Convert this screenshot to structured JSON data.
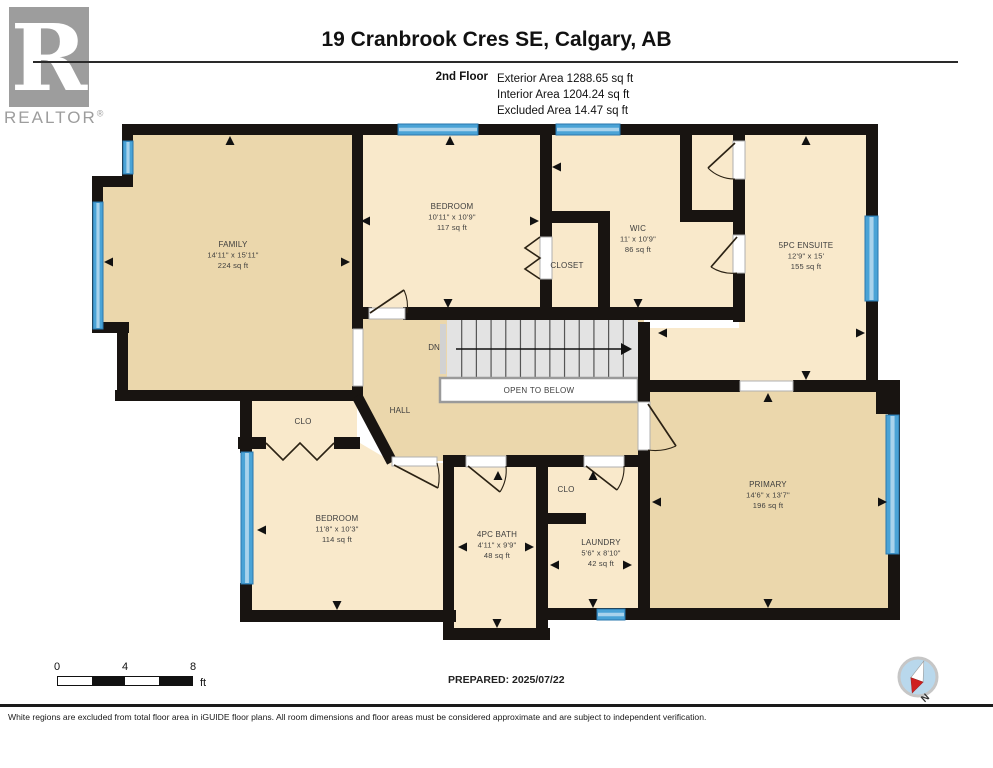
{
  "logo": {
    "letter": "R",
    "brand": "REALTOR",
    "registered": "®"
  },
  "header": {
    "title": "19 Cranbrook Cres SE, Calgary, AB",
    "floor_label": "2nd Floor",
    "stats": [
      "Exterior Area 1288.65 sq ft",
      "Interior Area 1204.24 sq ft",
      "Excluded Area 14.47 sq ft"
    ]
  },
  "scale_bar": {
    "tick_labels": [
      "0",
      "4",
      "8"
    ],
    "unit": "ft"
  },
  "prepared": "PREPARED: 2025/07/22",
  "compass": {
    "label": "N"
  },
  "disclaimer": "White regions are excluded from total floor area in iGUIDE floor plans. All room dimensions and floor areas must be considered approximate and are subject to independent verification.",
  "colors": {
    "tan": "#ebd7ac",
    "cream": "#f9e9cb",
    "wall": "#181411",
    "window_fill": "#4aa3d6",
    "window_edge": "#2a77ad",
    "window_stripe": "#a9d3ec",
    "stair_fill": "#e3e3e3",
    "stair_line": "#555555",
    "open_below_border": "#9a9a9a",
    "door": "#2b2214",
    "label": "#3d3d3d",
    "arrow": "#111111"
  },
  "plan": {
    "rooms": [
      {
        "id": "family",
        "fill": "tan",
        "points": [
          [
            128,
            130
          ],
          [
            357,
            130
          ],
          [
            357,
            395
          ],
          [
            120,
            395
          ],
          [
            120,
            328
          ],
          [
            98,
            328
          ],
          [
            98,
            182
          ],
          [
            128,
            182
          ]
        ]
      },
      {
        "id": "bedroom-2",
        "fill": "cream",
        "points": [
          [
            357,
            130
          ],
          [
            546,
            130
          ],
          [
            546,
            314
          ],
          [
            357,
            314
          ]
        ]
      },
      {
        "id": "closet",
        "fill": "cream",
        "points": [
          [
            546,
            217
          ],
          [
            604,
            217
          ],
          [
            604,
            314
          ],
          [
            546,
            314
          ]
        ]
      },
      {
        "id": "wic",
        "fill": "cream",
        "points": [
          [
            546,
            130
          ],
          [
            686,
            130
          ],
          [
            686,
            216
          ],
          [
            739,
            216
          ],
          [
            739,
            316
          ],
          [
            604,
            316
          ],
          [
            604,
            217
          ],
          [
            546,
            217
          ]
        ]
      },
      {
        "id": "water-closet",
        "fill": "cream",
        "points": [
          [
            686,
            130
          ],
          [
            739,
            130
          ],
          [
            739,
            216
          ],
          [
            686,
            216
          ]
        ]
      },
      {
        "id": "ensuite",
        "fill": "cream",
        "points": [
          [
            739,
            130
          ],
          [
            872,
            130
          ],
          [
            872,
            386
          ],
          [
            644,
            386
          ],
          [
            644,
            328
          ],
          [
            739,
            328
          ]
        ]
      },
      {
        "id": "hall",
        "fill": "tan",
        "points": [
          [
            357,
            310
          ],
          [
            644,
            310
          ],
          [
            644,
            461
          ],
          [
            390,
            461
          ],
          [
            355,
            398
          ],
          [
            357,
            390
          ]
        ]
      },
      {
        "id": "clo-hall",
        "fill": "cream",
        "points": [
          [
            246,
            396
          ],
          [
            357,
            396
          ],
          [
            357,
            443
          ],
          [
            246,
            443
          ]
        ]
      },
      {
        "id": "bedroom-3",
        "fill": "cream",
        "points": [
          [
            246,
            443
          ],
          [
            360,
            443
          ],
          [
            394,
            463
          ],
          [
            449,
            463
          ],
          [
            449,
            616
          ],
          [
            246,
            616
          ]
        ]
      },
      {
        "id": "bath",
        "fill": "cream",
        "points": [
          [
            449,
            461
          ],
          [
            542,
            461
          ],
          [
            542,
            634
          ],
          [
            449,
            634
          ]
        ]
      },
      {
        "id": "laundry",
        "fill": "cream",
        "points": [
          [
            542,
            461
          ],
          [
            644,
            461
          ],
          [
            644,
            614
          ],
          [
            542,
            614
          ]
        ]
      },
      {
        "id": "primary",
        "fill": "tan",
        "points": [
          [
            644,
            386
          ],
          [
            894,
            386
          ],
          [
            894,
            614
          ],
          [
            644,
            614
          ]
        ]
      }
    ],
    "walls": [
      [
        122,
        124,
        756,
        11
      ],
      [
        122,
        124,
        11,
        63
      ],
      [
        92,
        176,
        41,
        11
      ],
      [
        92,
        176,
        11,
        157
      ],
      [
        92,
        322,
        37,
        11
      ],
      [
        117,
        322,
        11,
        79
      ],
      [
        115,
        390,
        248,
        11
      ],
      [
        352,
        124,
        11,
        205
      ],
      [
        352,
        386,
        11,
        15
      ],
      [
        362,
        307,
        10,
        12
      ],
      [
        403,
        307,
        342,
        13
      ],
      [
        540,
        124,
        12,
        113
      ],
      [
        540,
        279,
        12,
        36
      ],
      [
        540,
        211,
        70,
        12
      ],
      [
        598,
        211,
        12,
        104
      ],
      [
        680,
        124,
        12,
        98
      ],
      [
        680,
        210,
        65,
        12
      ],
      [
        733,
        124,
        12,
        17
      ],
      [
        733,
        179,
        12,
        56
      ],
      [
        733,
        273,
        12,
        49
      ],
      [
        866,
        124,
        12,
        268
      ],
      [
        650,
        380,
        90,
        12
      ],
      [
        793,
        380,
        107,
        12
      ],
      [
        876,
        380,
        24,
        34
      ],
      [
        888,
        380,
        12,
        240
      ],
      [
        638,
        322,
        12,
        80
      ],
      [
        638,
        450,
        12,
        170
      ],
      [
        443,
        455,
        23,
        12
      ],
      [
        506,
        455,
        44,
        12
      ],
      [
        548,
        455,
        36,
        12
      ],
      [
        624,
        455,
        22,
        12
      ],
      [
        443,
        455,
        11,
        185
      ],
      [
        536,
        455,
        12,
        185
      ],
      [
        548,
        513,
        38,
        11
      ],
      [
        240,
        610,
        216,
        12
      ],
      [
        443,
        628,
        107,
        12
      ],
      [
        536,
        608,
        364,
        12
      ],
      [
        240,
        390,
        12,
        63
      ],
      [
        240,
        583,
        12,
        39
      ],
      [
        238,
        437,
        28,
        12
      ],
      [
        334,
        437,
        26,
        12
      ]
    ],
    "diag_walls": [
      [
        357,
        396,
        392,
        462
      ]
    ],
    "windows": [
      [
        123,
        141,
        10,
        33
      ],
      [
        93,
        202,
        10,
        127
      ],
      [
        398,
        124,
        80,
        11
      ],
      [
        556,
        124,
        64,
        11
      ],
      [
        865,
        216,
        13,
        85
      ],
      [
        886,
        415,
        13,
        139
      ],
      [
        241,
        452,
        12,
        132
      ],
      [
        597,
        609,
        28,
        11
      ]
    ],
    "openings": [
      {
        "x": 353,
        "y": 329,
        "w": 10,
        "h": 57
      },
      {
        "x": 369,
        "y": 308,
        "w": 36,
        "h": 11
      },
      {
        "x": 740,
        "y": 381,
        "w": 53,
        "h": 10
      },
      {
        "x": 733,
        "y": 141,
        "w": 12,
        "h": 38
      },
      {
        "x": 733,
        "y": 235,
        "w": 12,
        "h": 38
      },
      {
        "x": 540,
        "y": 237,
        "w": 12,
        "h": 42
      },
      {
        "x": 638,
        "y": 402,
        "w": 12,
        "h": 48
      },
      {
        "x": 466,
        "y": 456,
        "w": 40,
        "h": 11
      },
      {
        "x": 584,
        "y": 456,
        "w": 40,
        "h": 11
      },
      {
        "x": 392,
        "y": 457,
        "w": 45,
        "h": 9
      }
    ],
    "doors": [
      {
        "hx": 370,
        "hy": 313,
        "tx": 404,
        "ty": 290,
        "wx": 407,
        "wy": 313
      },
      {
        "hx": 735,
        "hy": 143,
        "tx": 708,
        "ty": 168,
        "wx": 735,
        "wy": 179
      },
      {
        "hx": 737,
        "hy": 237,
        "tx": 711,
        "ty": 267,
        "wx": 737,
        "wy": 273
      },
      {
        "hx": 648,
        "hy": 404,
        "tx": 676,
        "ty": 446,
        "wx": 648,
        "wy": 450
      },
      {
        "hx": 394,
        "hy": 465,
        "tx": 438,
        "ty": 488,
        "wx": 437,
        "wy": 463
      },
      {
        "hx": 468,
        "hy": 466,
        "tx": 500,
        "ty": 492,
        "wx": 506,
        "wy": 466
      },
      {
        "hx": 586,
        "hy": 466,
        "tx": 617,
        "ty": 490,
        "wx": 624,
        "wy": 466
      }
    ],
    "bifolds": [
      [
        [
          540,
          237
        ],
        [
          525,
          248
        ],
        [
          540,
          258
        ],
        [
          525,
          269
        ],
        [
          540,
          279
        ]
      ],
      [
        [
          266,
          443
        ],
        [
          283,
          460
        ],
        [
          300,
          443
        ],
        [
          317,
          460
        ],
        [
          334,
          443
        ]
      ]
    ],
    "stairs": {
      "x": 447,
      "y": 320,
      "w": 191,
      "h": 58,
      "treads": 12,
      "label": "DN",
      "label_x": 434,
      "label_y": 350
    },
    "open_below": {
      "x": 440,
      "y": 378,
      "w": 198,
      "h": 24,
      "label": "OPEN TO BELOW"
    },
    "arrows": [
      {
        "x": 230,
        "y": 141,
        "dir": "up"
      },
      {
        "x": 109,
        "y": 262,
        "dir": "left"
      },
      {
        "x": 345,
        "y": 262,
        "dir": "right"
      },
      {
        "x": 450,
        "y": 141,
        "dir": "up"
      },
      {
        "x": 366,
        "y": 221,
        "dir": "left"
      },
      {
        "x": 534,
        "y": 221,
        "dir": "right"
      },
      {
        "x": 557,
        "y": 167,
        "dir": "left"
      },
      {
        "x": 638,
        "y": 303,
        "dir": "down"
      },
      {
        "x": 448,
        "y": 303,
        "dir": "down"
      },
      {
        "x": 806,
        "y": 141,
        "dir": "up"
      },
      {
        "x": 663,
        "y": 333,
        "dir": "left"
      },
      {
        "x": 860,
        "y": 333,
        "dir": "right"
      },
      {
        "x": 806,
        "y": 375,
        "dir": "down"
      },
      {
        "x": 768,
        "y": 398,
        "dir": "up"
      },
      {
        "x": 657,
        "y": 502,
        "dir": "left"
      },
      {
        "x": 882,
        "y": 502,
        "dir": "right"
      },
      {
        "x": 768,
        "y": 603,
        "dir": "down"
      },
      {
        "x": 262,
        "y": 530,
        "dir": "left"
      },
      {
        "x": 337,
        "y": 605,
        "dir": "down"
      },
      {
        "x": 498,
        "y": 476,
        "dir": "up"
      },
      {
        "x": 463,
        "y": 547,
        "dir": "left"
      },
      {
        "x": 529,
        "y": 547,
        "dir": "right"
      },
      {
        "x": 497,
        "y": 623,
        "dir": "down"
      },
      {
        "x": 593,
        "y": 476,
        "dir": "up"
      },
      {
        "x": 555,
        "y": 565,
        "dir": "left"
      },
      {
        "x": 627,
        "y": 565,
        "dir": "right"
      },
      {
        "x": 593,
        "y": 603,
        "dir": "down"
      }
    ],
    "labels": [
      {
        "id": "family",
        "x": 233,
        "y": 247,
        "lines": [
          "FAMILY",
          "14'11\" x 15'11\"",
          "224 sq ft"
        ]
      },
      {
        "id": "bedroom-2",
        "x": 452,
        "y": 209,
        "lines": [
          "BEDROOM",
          "10'11\" x 10'9\"",
          "117 sq ft"
        ]
      },
      {
        "id": "closet",
        "x": 567,
        "y": 268,
        "lines": [
          "CLOSET"
        ]
      },
      {
        "id": "wic",
        "x": 638,
        "y": 231,
        "lines": [
          "WIC",
          "11' x 10'9\"",
          "86 sq ft"
        ]
      },
      {
        "id": "ensuite",
        "x": 806,
        "y": 248,
        "lines": [
          "5PC ENSUITE",
          "12'9\" x 15'",
          "155 sq ft"
        ]
      },
      {
        "id": "hall",
        "x": 400,
        "y": 413,
        "lines": [
          "HALL"
        ]
      },
      {
        "id": "clo-hall",
        "x": 303,
        "y": 424,
        "lines": [
          "CLO"
        ]
      },
      {
        "id": "bedroom-3",
        "x": 337,
        "y": 521,
        "lines": [
          "BEDROOM",
          "11'8\" x 10'3\"",
          "114 sq ft"
        ]
      },
      {
        "id": "bath",
        "x": 497,
        "y": 537,
        "lines": [
          "4PC BATH",
          "4'11\" x 9'9\"",
          "48 sq ft"
        ]
      },
      {
        "id": "clo-laundry",
        "x": 566,
        "y": 492,
        "lines": [
          "CLO"
        ]
      },
      {
        "id": "laundry",
        "x": 601,
        "y": 545,
        "lines": [
          "LAUNDRY",
          "5'6\" x 8'10\"",
          "42 sq ft"
        ]
      },
      {
        "id": "primary",
        "x": 768,
        "y": 487,
        "lines": [
          "PRIMARY",
          "14'6\" x 13'7\"",
          "196 sq ft"
        ]
      }
    ]
  }
}
